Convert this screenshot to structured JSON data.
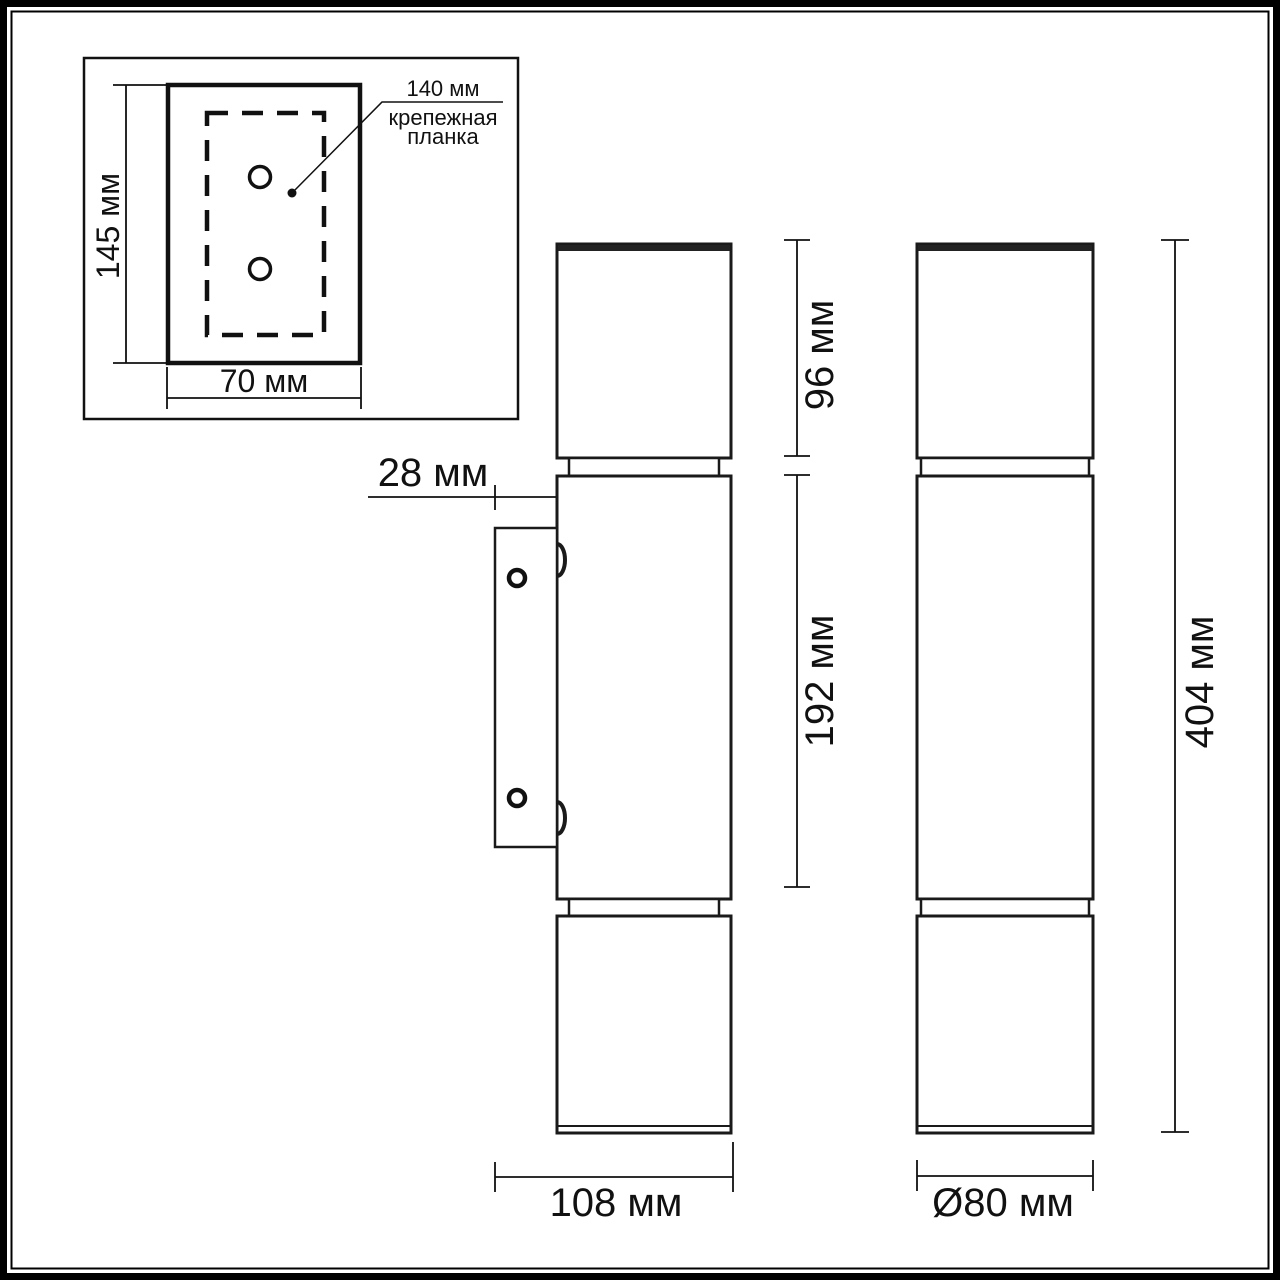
{
  "drawing": {
    "title": "wall-luminaire-dimension-drawing",
    "line_color": "#111111",
    "background": "#ffffff"
  },
  "inset": {
    "height_label": "145 мм",
    "width_label": "70 мм",
    "leader_value": "140 мм",
    "leader_caption_line1": "крепежная",
    "leader_caption_line2": "планка"
  },
  "side_view": {
    "wall_offset_label": "28 мм",
    "top_section_label": "96 мм",
    "body_section_label": "192 мм",
    "depth_label": "108 мм"
  },
  "front_view": {
    "total_height_label": "404 мм",
    "diameter_label": "Ø80 мм"
  }
}
